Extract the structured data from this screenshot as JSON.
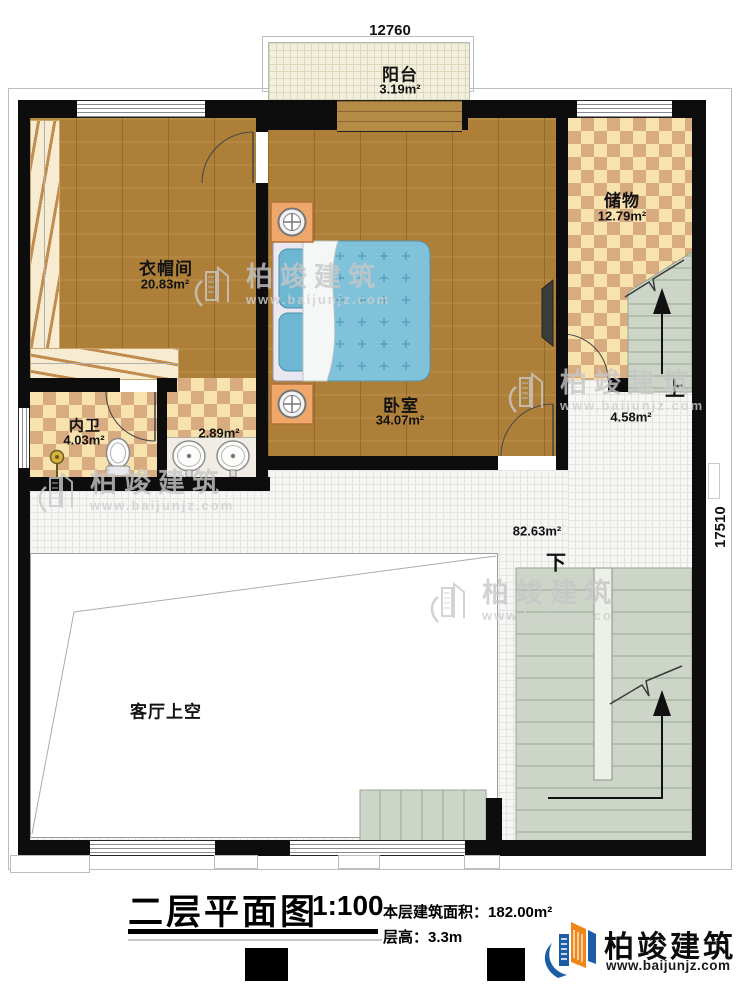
{
  "dimensions": {
    "top": "12760",
    "right": "17510"
  },
  "rooms": {
    "balcony": {
      "name": "阳台",
      "area": "3.19m²"
    },
    "storage": {
      "name": "储物",
      "area": "12.79m²"
    },
    "cloakroom": {
      "name": "衣帽间",
      "area": "20.83m²"
    },
    "bedroom": {
      "name": "卧室",
      "area": "34.07m²"
    },
    "bathroom": {
      "name": "内卫",
      "area": "4.03m²"
    },
    "vanity": {
      "area": "2.89m²"
    },
    "stair_hall": {
      "area": "4.58m²"
    },
    "hallway": {
      "area": "82.63m²"
    },
    "living_void": {
      "name": "客厅上空"
    }
  },
  "stairs": {
    "up_label": "上",
    "down_label": "下"
  },
  "title_block": {
    "title": "二层平面图",
    "scale": "1:100",
    "area_label": "本层建筑面积：",
    "area_value": "182.00m²",
    "height_label": "层高：",
    "height_value": "3.3m"
  },
  "watermark": {
    "name": "柏竣建筑",
    "url": "www.baijunjz.com"
  },
  "logo": {
    "name": "柏竣建筑",
    "url": "www.baijunjz.com"
  },
  "colors": {
    "wall": "#0d0d0d",
    "wood": "#ad7f38",
    "checker_light": "#f8e3ae",
    "checker_dark": "#d9ab80",
    "stair": "#ccd5c7",
    "bed_blue": "#80c3da",
    "logo_blue": "#1b5ea6",
    "logo_orange": "#f08519"
  }
}
